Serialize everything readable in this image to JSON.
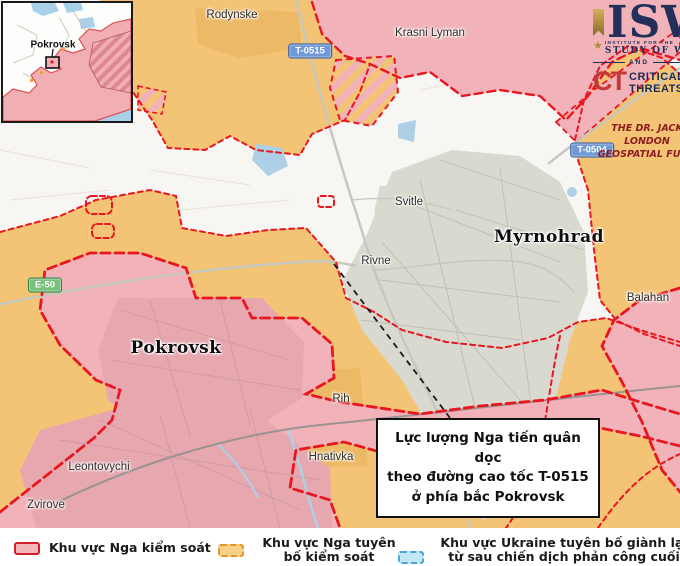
{
  "inset": {
    "label": "Pokrovsk"
  },
  "logo": {
    "isw": "ISW",
    "institute_line1": "INSTITUTE FOR THE",
    "institute_line2": "STUDY OF WAR",
    "and": "AND",
    "ct": "CT",
    "critical": "CRITICAL",
    "threats": "THREATS",
    "fund_line1": "THE DR. JACK LONDON",
    "fund_line2": "GEOSPATIAL FUND"
  },
  "map": {
    "labels": [
      {
        "text": "Rodynske",
        "x": 232,
        "y": 15,
        "style": "town"
      },
      {
        "text": "Krasni Lyman",
        "x": 430,
        "y": 33,
        "style": "town"
      },
      {
        "text": "Svitle",
        "x": 409,
        "y": 202,
        "style": "town"
      },
      {
        "text": "Myrnohrad",
        "x": 549,
        "y": 237,
        "style": "city"
      },
      {
        "text": "Rivne",
        "x": 376,
        "y": 261,
        "style": "town"
      },
      {
        "text": "Balahan",
        "x": 648,
        "y": 298,
        "style": "town"
      },
      {
        "text": "Pokrovsk",
        "x": 176,
        "y": 348,
        "style": "city"
      },
      {
        "text": "Rih",
        "x": 341,
        "y": 399,
        "style": "town"
      },
      {
        "text": "Hnativka",
        "x": 331,
        "y": 457,
        "style": "town"
      },
      {
        "text": "Leontovychi",
        "x": 99,
        "y": 467,
        "style": "town"
      },
      {
        "text": "Zvirove",
        "x": 46,
        "y": 505,
        "style": "town"
      }
    ],
    "road_badges": [
      {
        "text": "T-0515",
        "x": 310,
        "y": 51,
        "type": "blue"
      },
      {
        "text": "T-0504",
        "x": 592,
        "y": 150,
        "type": "blue"
      },
      {
        "text": "E-50",
        "x": 45,
        "y": 285,
        "type": "green"
      }
    ]
  },
  "annotation": {
    "lines": [
      "Lực lượng Nga tiến quân dọc",
      "theo đường cao tốc  T-0515",
      "ở phía bắc Pokrovsk"
    ]
  },
  "legend": {
    "items": [
      {
        "label": "Khu vực Nga kiểm soát",
        "swatch": "controlled"
      },
      {
        "label": "Khu vực Nga tuyên bố kiểm soát",
        "swatch": "claimed"
      },
      {
        "label": "Khu vực Ukraine tuyên bố giành lại từ sau chiến dịch phản công cuối năm 2022",
        "swatch": "regained"
      }
    ]
  },
  "colors": {
    "russian_controlled": "#f1b3b9",
    "russian_claimed": "#f3c475",
    "ukraine_regained": "#c3e7f6",
    "frontline_red": "#e9161f",
    "urban_gray": "#dad9d0",
    "water_blue": "#aed0e6"
  }
}
